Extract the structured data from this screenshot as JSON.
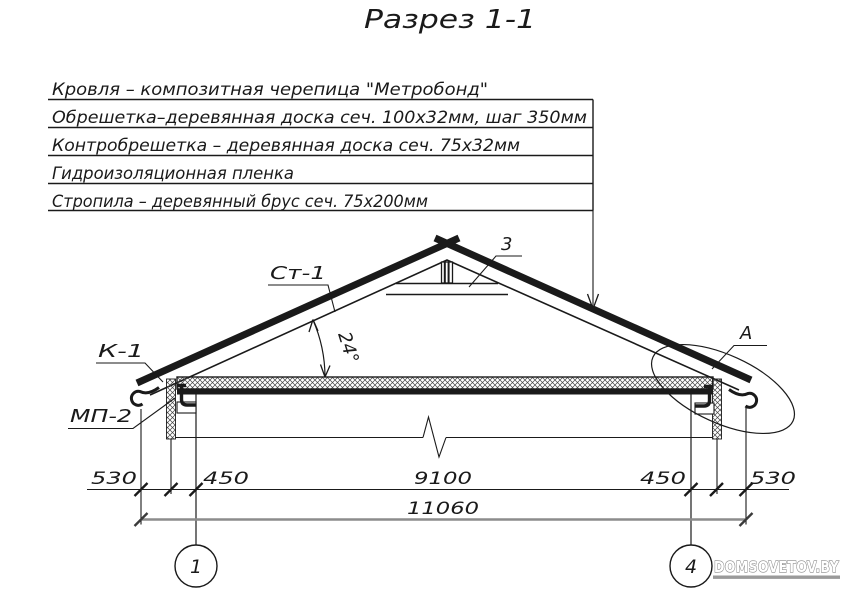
{
  "title": "Разрез 1-1",
  "specs": [
    "Кровля – композитная черепица \"Метробонд\"",
    "Обрешетка–деревянная доска сеч. 100х32мм, шаг 350мм",
    "Контробрешетка – деревянная доска сеч. 75х32мм",
    "Гидроизоляционная пленка",
    "Стропила – деревянный брус сеч. 75х200мм"
  ],
  "callouts": {
    "rafter": "Ст-1",
    "tie": "3",
    "eave": "К-1",
    "mount": "МП-2",
    "detail": "А",
    "slope_angle": "24°"
  },
  "dimensions": {
    "segments": [
      "530",
      "450",
      "9100",
      "450",
      "530"
    ],
    "total": "11060"
  },
  "axis_markers": [
    "1",
    "4"
  ],
  "watermark": "DOMSOVETOV.BY",
  "colors": {
    "line": "#1a1a1a",
    "total_dim_line": "#8c8c8c",
    "watermark": "#9a9a9a",
    "background": "#ffffff"
  }
}
